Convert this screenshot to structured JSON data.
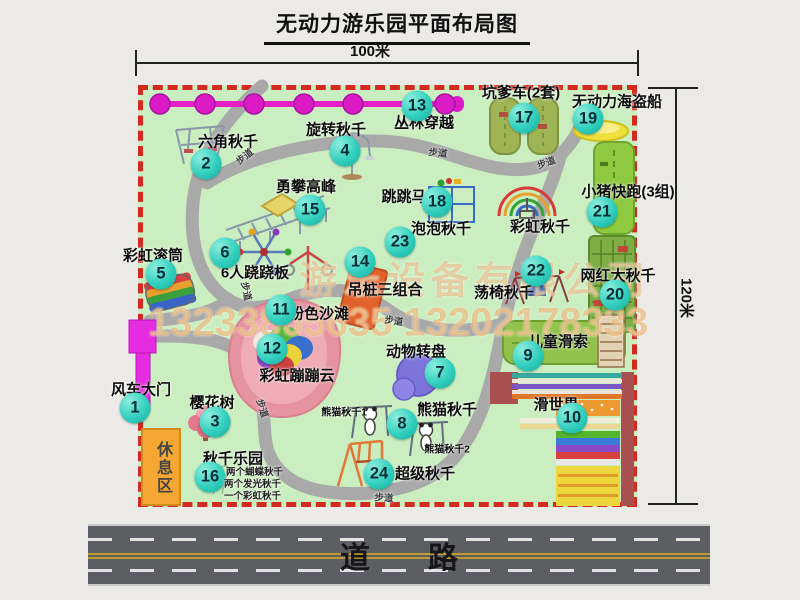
{
  "title": "无动力游乐园平面布局图",
  "dimensions": {
    "width": "100米",
    "height": "120米"
  },
  "watermark": {
    "company": "游乐设备有限公司",
    "phone": "13233805635 13202178333"
  },
  "road_label": "道路",
  "rest_area_label": "休息区",
  "trail_label": "步道",
  "attractions": [
    {
      "num": "1",
      "name": "风车大门"
    },
    {
      "num": "2",
      "name": "六角秋千"
    },
    {
      "num": "3",
      "name": "樱花树"
    },
    {
      "num": "4",
      "name": "旋转秋千"
    },
    {
      "num": "5",
      "name": "彩虹滚筒"
    },
    {
      "num": "6",
      "name": "6人跷跷板"
    },
    {
      "num": "7",
      "name": "动物转盘"
    },
    {
      "num": "8",
      "name": "熊猫秋千"
    },
    {
      "num": "9",
      "name": "儿童滑索"
    },
    {
      "num": "10",
      "name": "滑世界"
    },
    {
      "num": "11",
      "name": "粉色沙滩"
    },
    {
      "num": "12",
      "name": "彩虹蹦蹦云"
    },
    {
      "num": "13",
      "name": "丛林穿越"
    },
    {
      "num": "14",
      "name": "吊桩三组合"
    },
    {
      "num": "15",
      "name": "勇攀高峰"
    },
    {
      "num": "16",
      "name": "秋千乐园"
    },
    {
      "num": "17",
      "name": "坑爹车(2套)"
    },
    {
      "num": "18",
      "name": "跳跳马"
    },
    {
      "num": "19",
      "name": "无动力海盗船"
    },
    {
      "num": "20",
      "name": "网红大秋千"
    },
    {
      "num": "21",
      "name": "小猪快跑(3组)"
    },
    {
      "num": "22",
      "name": "荡椅秋千"
    },
    {
      "num": "23",
      "name": "泡泡秋千"
    },
    {
      "num": "24",
      "name": "超级秋千"
    }
  ],
  "extra_labels": {
    "rainbow_swing": "彩虹秋千"
  },
  "sub_labels": {
    "panda1": "熊猫秋千1",
    "panda2": "熊猫秋千2"
  },
  "swing_park_notes": [
    "两个蝴蝶秋千",
    "两个发光秋千",
    "一个彩虹秋千"
  ]
}
